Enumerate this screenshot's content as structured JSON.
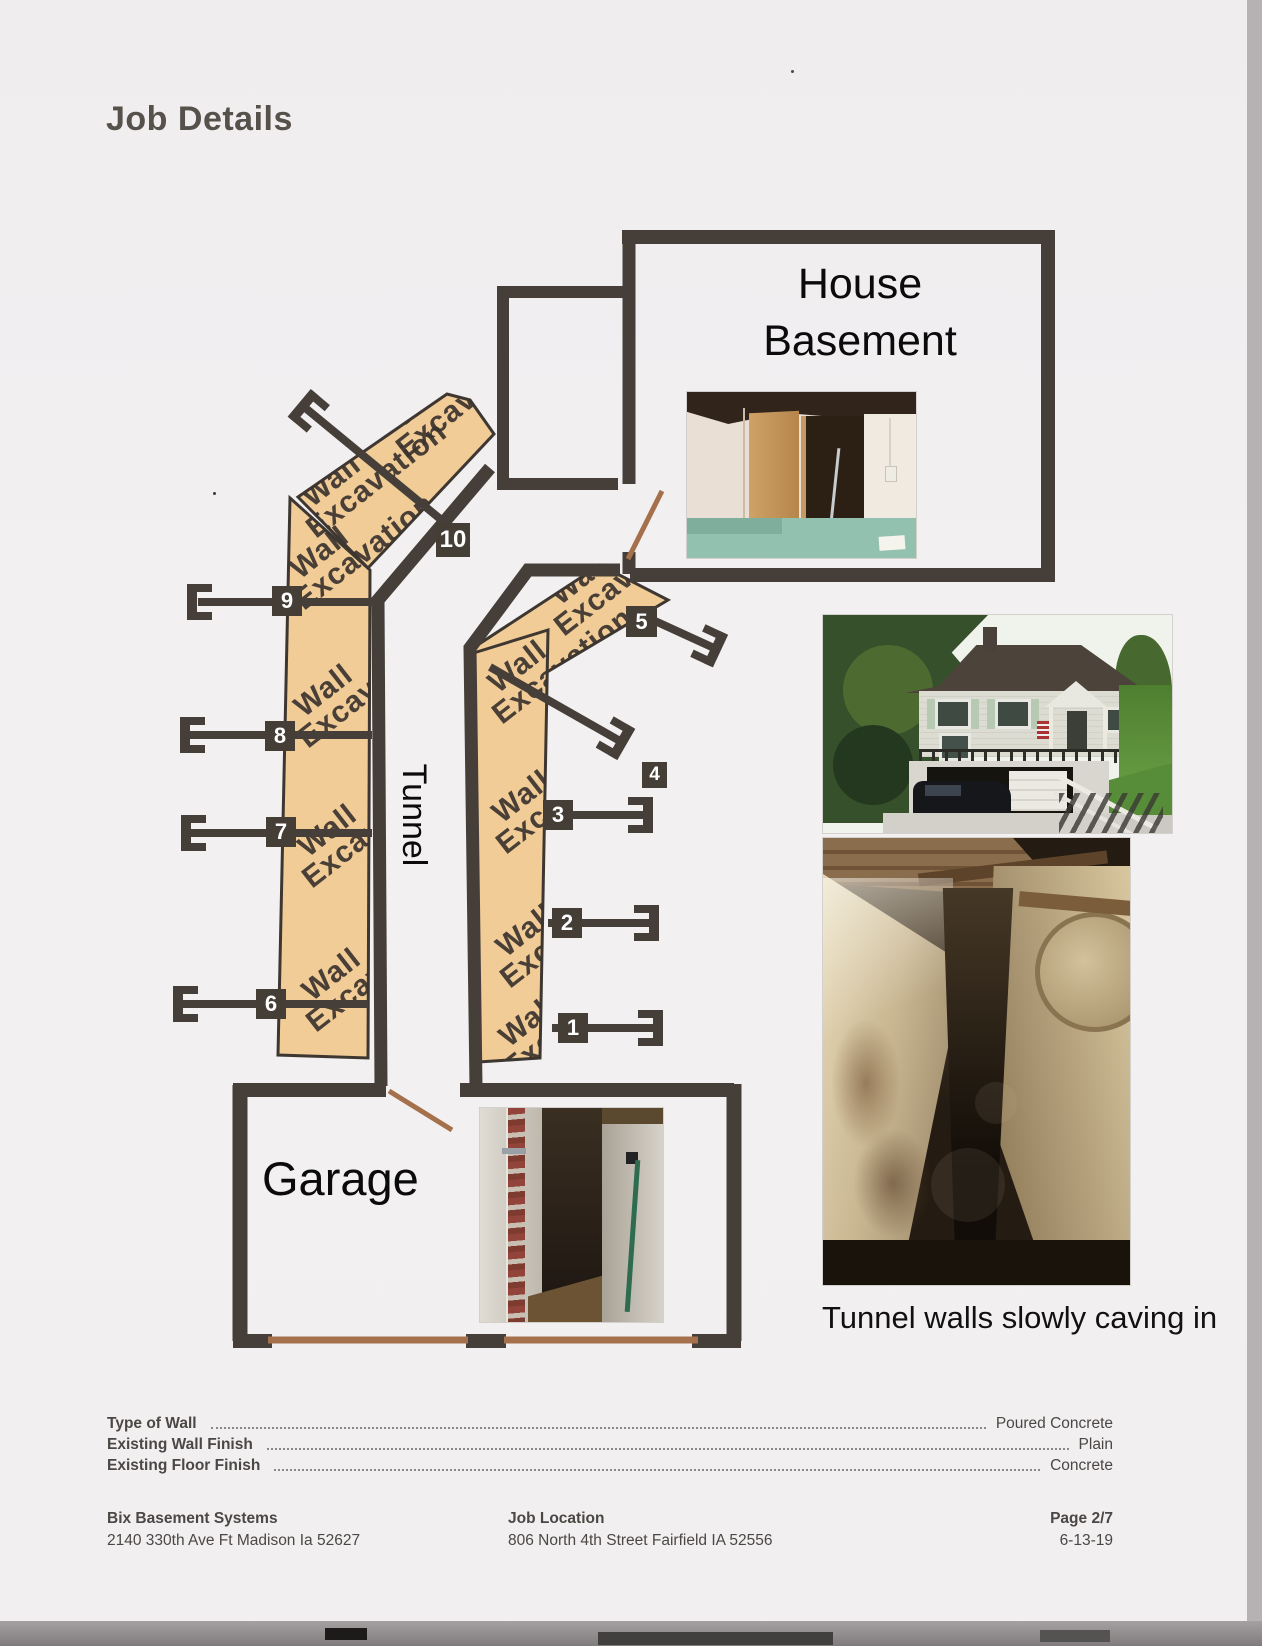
{
  "page": {
    "title": "Job Details"
  },
  "plan": {
    "labels": {
      "house_line1": "House",
      "house_line2": "Basement",
      "garage": "Garage",
      "tunnel": "Tunnel"
    },
    "watermark_line1": "Wall",
    "watermark_line2": "Excavation",
    "markers": [
      {
        "n": "1"
      },
      {
        "n": "2"
      },
      {
        "n": "3"
      },
      {
        "n": "4"
      },
      {
        "n": "5"
      },
      {
        "n": "6"
      },
      {
        "n": "7"
      },
      {
        "n": "8"
      },
      {
        "n": "9"
      },
      {
        "n": "10"
      }
    ],
    "colors": {
      "wall": "#463f39",
      "excavation_fill": "#f1cc97",
      "door_leader": "#a5714d",
      "marker_bg": "#453e37"
    }
  },
  "photos": {
    "caption_tunnel": "Tunnel walls slowly caving in"
  },
  "details": {
    "rows": [
      {
        "label": "Type of Wall",
        "value": "Poured Concrete"
      },
      {
        "label": "Existing Wall Finish",
        "value": "Plain"
      },
      {
        "label": "Existing Floor Finish",
        "value": "Concrete"
      }
    ]
  },
  "footer": {
    "company_name": "Bix Basement Systems",
    "company_address": "2140 330th Ave Ft Madison  Ia 52627",
    "job_location_label": "Job Location",
    "job_location_address": "806 North 4th Street Fairfield IA 52556",
    "page_label": "Page 2/7",
    "date": "6-13-19"
  }
}
